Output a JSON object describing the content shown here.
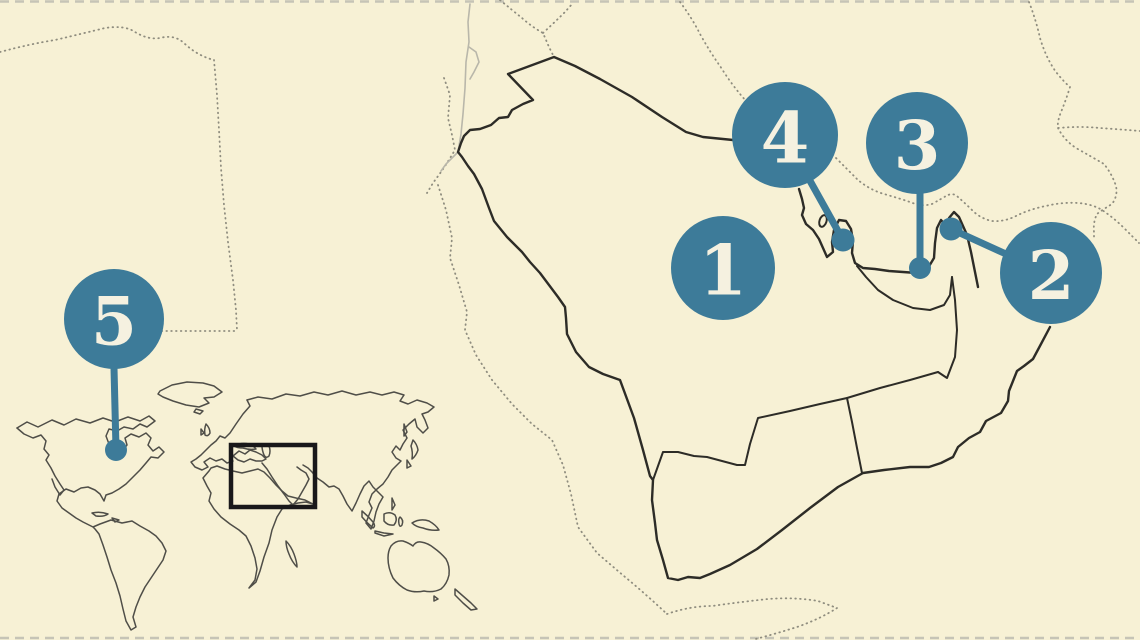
{
  "page": {
    "description": "Geography quiz map of the Arabian Peninsula and Persian Gulf with five numbered location markers and a world-map inset highlighting the region"
  },
  "map": {
    "colors": {
      "background": "#f7f1d5",
      "accent": "#3d7b99",
      "marker_text": "#f5f1e0",
      "outline": "#2d2c27",
      "dotted": "#8f8d7f",
      "faint": "#b9b7aa",
      "world": "#4f4e48",
      "highlight_box": "#19181a",
      "neatline": "#c6c4b6"
    },
    "markers": [
      {
        "label": "1",
        "cx": 723,
        "cy": 268,
        "r": 52,
        "leader": null,
        "dot": null
      },
      {
        "label": "2",
        "cx": 1051,
        "cy": 273,
        "r": 51,
        "leader": {
          "x1": 1006,
          "y1": 254,
          "x2": 951,
          "y2": 229
        },
        "dot": {
          "x": 951,
          "y": 229,
          "r": 11.5
        }
      },
      {
        "label": "3",
        "cx": 917,
        "cy": 143,
        "r": 51,
        "leader": {
          "x1": 920,
          "y1": 190,
          "x2": 920,
          "y2": 267
        },
        "dot": {
          "x": 920,
          "y": 268,
          "r": 11
        }
      },
      {
        "label": "4",
        "cx": 785,
        "cy": 135,
        "r": 53,
        "leader": {
          "x1": 809,
          "y1": 179,
          "x2": 843,
          "y2": 240
        },
        "dot": {
          "x": 843,
          "y": 240,
          "r": 11.5
        }
      },
      {
        "label": "5",
        "cx": 114,
        "cy": 319,
        "r": 50,
        "leader": {
          "x1": 114,
          "y1": 368,
          "x2": 116,
          "y2": 449
        },
        "dot": {
          "x": 116,
          "y": 450,
          "r": 11
        }
      }
    ],
    "world_inset": {
      "highlight_rect": {
        "x": 231,
        "y": 445,
        "width": 84,
        "height": 62
      }
    }
  }
}
